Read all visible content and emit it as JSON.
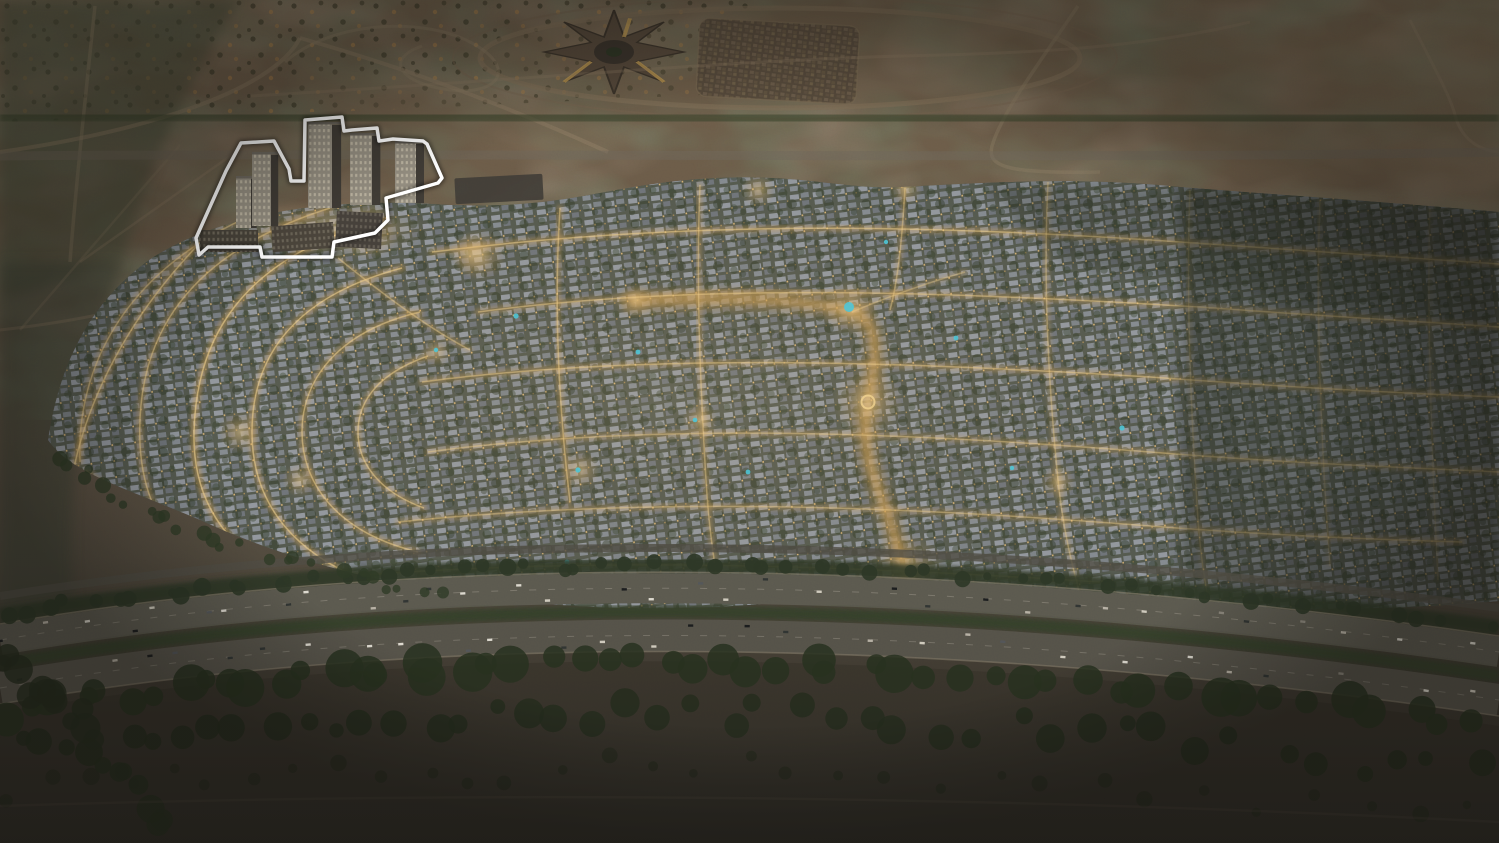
{
  "scene": {
    "description": "Dusk aerial rendering of a large master-planned desert community with illuminated golden streets and grey villa rows, a cluster of residential towers highlighted by a white outline at the upper left, a racecourse and souk complex in the open desert beyond, and a busy multi-lane highway lined with trees in the foreground.",
    "time_of_day": "dusk",
    "highlight": {
      "target": "tower-cluster",
      "outline_color": "#ffffff"
    }
  },
  "palette": {
    "desert_top": "#6e5e4b",
    "desert_light": "#7b6955",
    "desert_shadow": "#4e463a",
    "vegetation_dark": "#39422c",
    "community_base": "#565a50",
    "roof_light": "#9aa0a9",
    "roof_mid": "#7d828b",
    "street_glow": "#d9a85e",
    "street_core": "#f3d38f",
    "tree_green": "#2f3a27",
    "pool_teal": "#4cc4d6",
    "highway_asphalt": "#5a584f",
    "highway_shoulder": "#7e7666",
    "foreground_dark": "#332f28",
    "tower_face": "#938d80",
    "tower_side": "#3f3b35",
    "window_warm": "#eec27b",
    "outline_white": "#ffffff"
  }
}
